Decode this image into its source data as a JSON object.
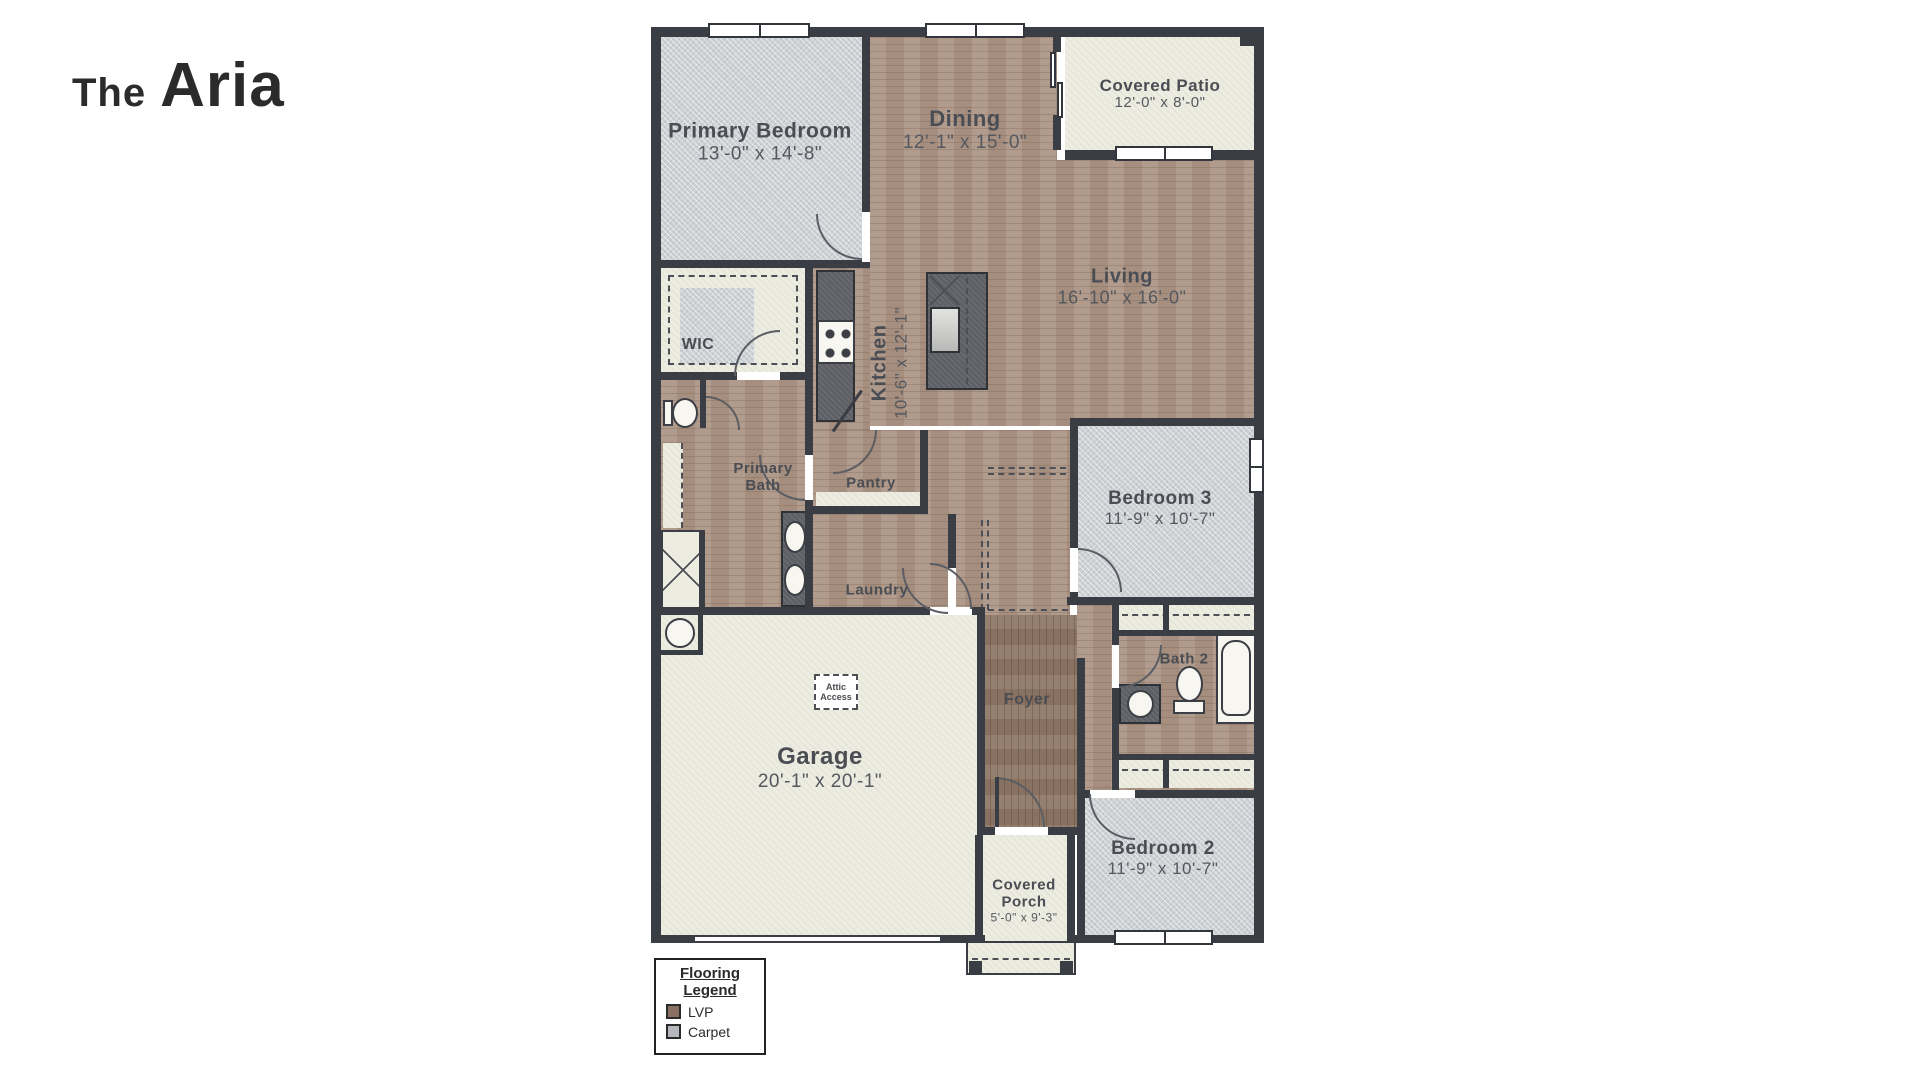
{
  "title": {
    "prefix": "The",
    "name": "Aria"
  },
  "rooms": {
    "primary_bedroom": {
      "label": "Primary Bedroom",
      "dims": "13'-0\" x 14'-8\""
    },
    "dining": {
      "label": "Dining",
      "dims": "12'-1\" x 15'-0\""
    },
    "covered_patio": {
      "label": "Covered Patio",
      "dims": "12'-0\" x 8'-0\""
    },
    "living": {
      "label": "Living",
      "dims": "16'-10\" x 16'-0\""
    },
    "kitchen": {
      "label": "Kitchen",
      "dims": "10'-6\" x 12'-1\""
    },
    "wic": {
      "label": "WIC"
    },
    "primary_bath": {
      "label": "Primary Bath"
    },
    "pantry": {
      "label": "Pantry"
    },
    "laundry": {
      "label": "Laundry"
    },
    "bedroom3": {
      "label": "Bedroom 3",
      "dims": "11'-9\" x 10'-7\""
    },
    "bath2": {
      "label": "Bath 2"
    },
    "foyer": {
      "label": "Foyer"
    },
    "garage": {
      "label": "Garage",
      "dims": "20'-1\" x 20'-1\""
    },
    "attic_access": {
      "label": "Attic Access"
    },
    "covered_porch": {
      "label": "Covered Porch",
      "dims": "5'-0\" x 9'-3\""
    },
    "bedroom2": {
      "label": "Bedroom 2",
      "dims": "11'-9\" x 10'-7\""
    }
  },
  "legend": {
    "title": "Flooring Legend",
    "items": [
      {
        "label": "LVP",
        "color": "#8a7060"
      },
      {
        "label": "Carpet",
        "color": "#b5b9bd"
      }
    ]
  },
  "colors": {
    "lvp_floor": "#ac9585",
    "foyer_floor": "#8f7867",
    "carpet_floor": "#ced2d5",
    "concrete_floor": "#edece1",
    "wall": "#3a3d43",
    "counter": "#5e6066",
    "label_text": "#4a4d53"
  }
}
